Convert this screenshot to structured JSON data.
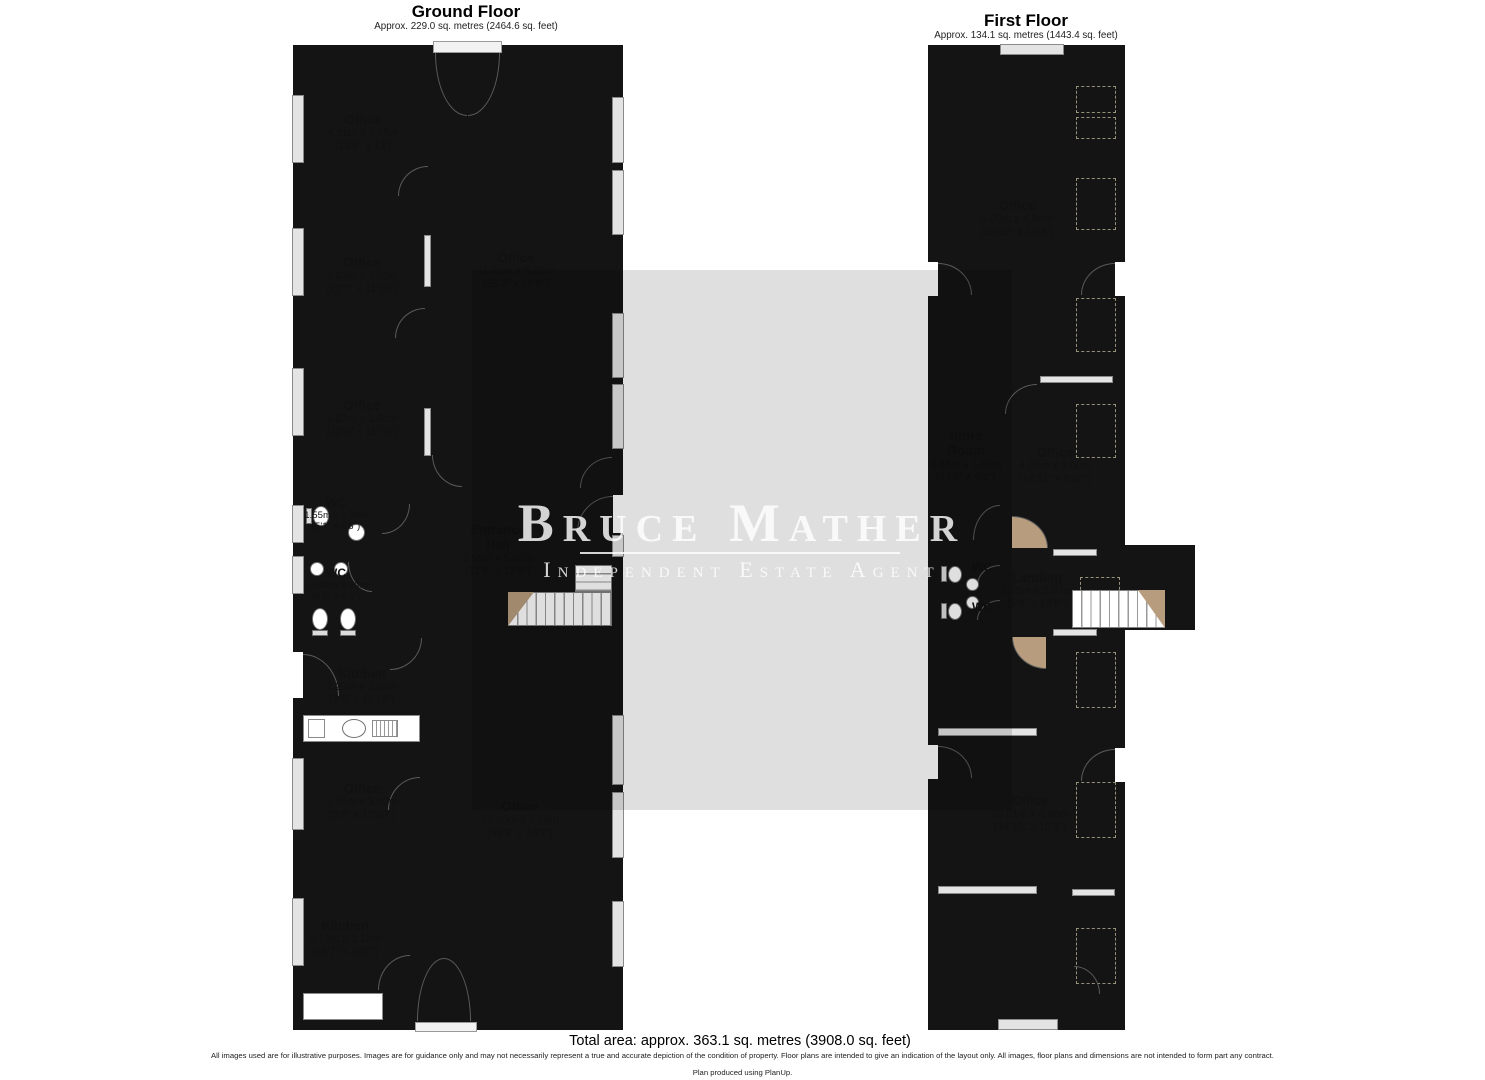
{
  "ground_floor": {
    "title": "Ground Floor",
    "subtitle": "Approx. 229.0 sq. metres (2464.6 sq. feet)",
    "rooms": [
      {
        "name": "Office",
        "metric": "4.11m x 3.65m",
        "imperial": "(13'6\" x 12')"
      },
      {
        "name": "Office",
        "metric": "3.83m x 3.60m",
        "imperial": "(12'7\" x 11'10\")"
      },
      {
        "name": "Office",
        "metric": "11.95m x 5.08m",
        "imperial": "(39'2\" x 16'8\")"
      },
      {
        "name": "Office",
        "metric": "3.82m x 3.60m",
        "imperial": "(12'6\" x 11'10\")"
      },
      {
        "name": "WC",
        "metric": "1.55m x 1.99m",
        "imperial": "(5'1\" x 6'6\")"
      },
      {
        "name": "WC",
        "metric": "2.64m x 1.99m",
        "imperial": "(8'8\" x 6'6\")"
      },
      {
        "name": "Entrance Hall",
        "metric": "3.56m x 5.07m",
        "imperial": "(11'8\" x 16'8\")"
      },
      {
        "name": "Kitchen",
        "metric": "2.27m x 3.60m",
        "imperial": "(7'5\" x 11'10\")"
      },
      {
        "name": "Office",
        "metric": "2.95m x 3.60m",
        "imperial": "(9'8\" x 11'10\")"
      },
      {
        "name": "Office",
        "metric": "10.60m x 5.54m",
        "imperial": "(34'9\" x 18'2\")"
      },
      {
        "name": "Kitchen",
        "metric": "4.14m x 3.18m",
        "imperial": "(13'7\" x 10'5\")"
      }
    ]
  },
  "first_floor": {
    "title": "First Floor",
    "subtitle": "Approx. 134.1 sq. metres (1443.4 sq. feet)",
    "rooms": [
      {
        "name": "Office",
        "metric": "9.09m x 4.96m",
        "imperial": "(29'10\" x 16'3\")"
      },
      {
        "name": "Store Room",
        "metric": "4.46m x 1.88m",
        "imperial": "(14'8\" x 6'2\")"
      },
      {
        "name": "Office",
        "metric": "4.54m x 3.00m",
        "imperial": "(14'11\" x 9'10\")"
      },
      {
        "name": "WC"
      },
      {
        "name": "WC"
      },
      {
        "name": "Landing",
        "metric": "1.75m x 5.07m",
        "imperial": "(5'9\" x 16'8\")"
      },
      {
        "name": "Office",
        "metric": "10.61m x 4.96m",
        "imperial": "(34'10\" x 16'3\")"
      }
    ]
  },
  "watermark": {
    "line1": "Bruce Mather",
    "line2": "Independent Estate Agent"
  },
  "footer": {
    "total_area": "Total area: approx. 363.1 sq. metres (3908.0 sq. feet)",
    "disclaimer": "All images used are for illustrative purposes. Images are for guidance only and may not necessarily represent a true and accurate depiction of the condition of property. Floor plans are intended to give an indication of the layout only. All images, floor plans and dimensions are not intended to form part any contract.",
    "produced_by": "Plan produced using PlanUp."
  },
  "palette": {
    "floor": "#f7f1d8",
    "hall_tan": "#b79d7d",
    "wc_blue": "#a9d3e2",
    "wall": "#141414",
    "store_outer": "#d7d7d7",
    "store_inner": "#a6a6a6"
  }
}
